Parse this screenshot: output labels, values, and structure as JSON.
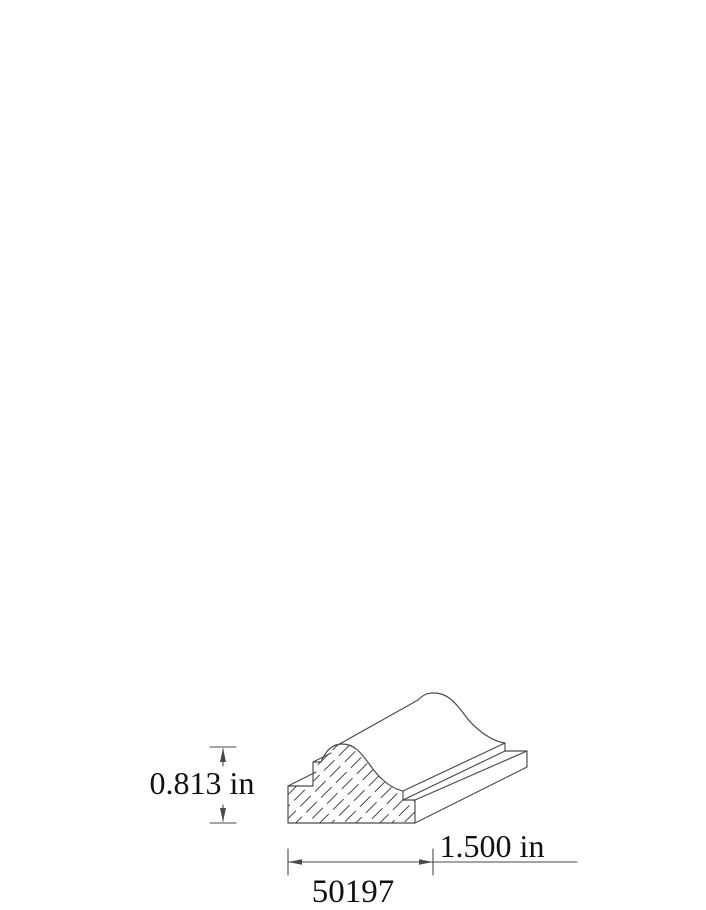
{
  "drawing": {
    "type": "molding-profile-technical-drawing",
    "part_number": "50197",
    "dimensions": {
      "height_label": "0.813 in",
      "width_label": "1.500 in"
    }
  },
  "colors": {
    "line": "#4a4a4a",
    "text": "#111111",
    "background": "#ffffff"
  }
}
